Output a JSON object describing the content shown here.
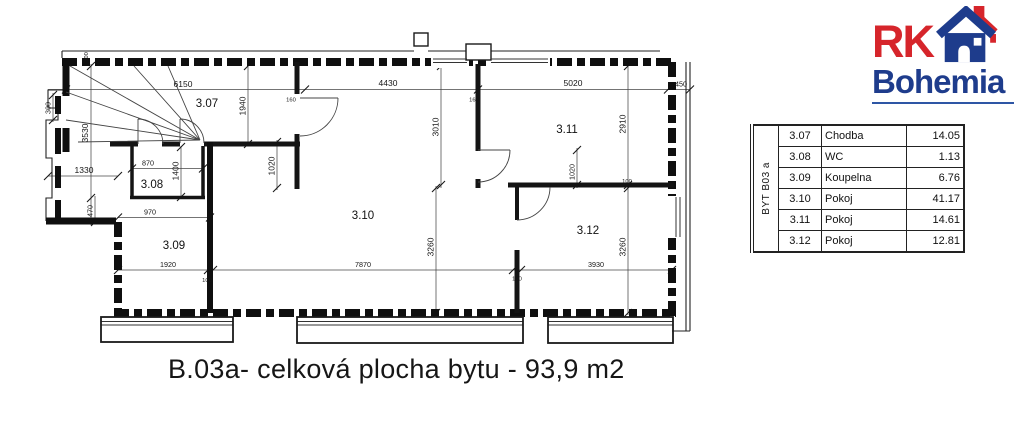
{
  "logo": {
    "rk": "RK",
    "bohemia": "Bohemia"
  },
  "caption": "B.03a- celková plocha bytu - 93,9 m2",
  "legend": {
    "title": "BYT B03 a",
    "rows": [
      {
        "id": "3.07",
        "name": "Chodba",
        "area": "14.05"
      },
      {
        "id": "3.08",
        "name": "WC",
        "area": "1.13"
      },
      {
        "id": "3.09",
        "name": "Koupelna",
        "area": "6.76"
      },
      {
        "id": "3.10",
        "name": "Pokoj",
        "area": "41.17"
      },
      {
        "id": "3.11",
        "name": "Pokoj",
        "area": "14.61"
      },
      {
        "id": "3.12",
        "name": "Pokoj",
        "area": "12.81"
      }
    ]
  },
  "plan": {
    "rooms": {
      "r307": "3.07",
      "r308": "3.08",
      "r309": "3.09",
      "r310": "3.10",
      "r311": "3.11",
      "r312": "3.12"
    },
    "dims": {
      "d6150": "6150",
      "d4430": "4430",
      "d5020": "5020",
      "d450": "450",
      "d1330": "1330",
      "d870": "870",
      "d970": "970",
      "d1920": "1920",
      "d7870": "7870",
      "d3930": "3930",
      "v300a": "300",
      "v300b": "300",
      "v3530": "3530",
      "v470": "470",
      "v1940": "1940",
      "v1400": "1400",
      "v1020a": "1020",
      "v1020b": "1020",
      "v3010": "3010",
      "v2910": "2910",
      "v3260a": "3260",
      "v3260b": "3260",
      "s160a": "160",
      "s160b": "160",
      "s100a": "100",
      "s100b": "100",
      "s100c": "100"
    }
  }
}
